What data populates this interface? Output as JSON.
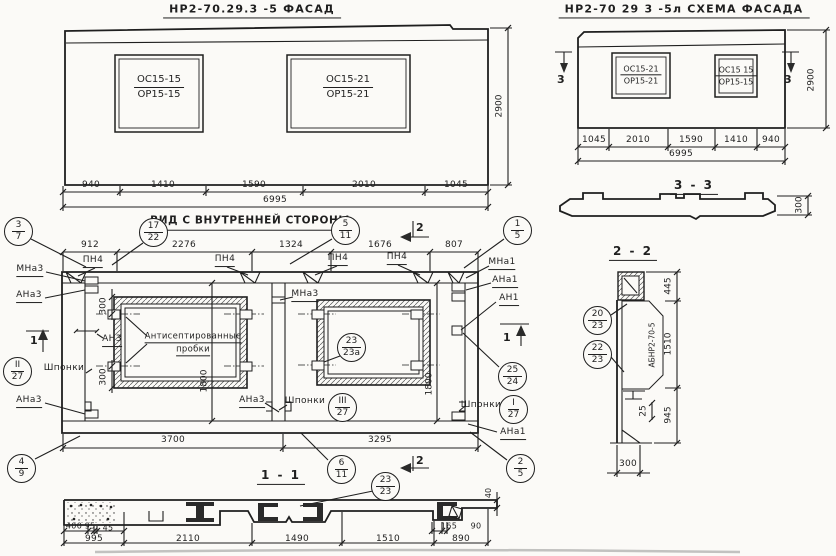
{
  "facade": {
    "title": "НР2-70.29.3 -5   ФАСАД",
    "win1": {
      "t": "ОС15-15",
      "b": "ОР15-15"
    },
    "win2": {
      "t": "ОС15-21",
      "b": "ОР15-21"
    },
    "dims": [
      "940",
      "1410",
      "1590",
      "2010",
      "1045"
    ],
    "total": "6995",
    "height": "2900"
  },
  "scheme": {
    "title": "НР2-70 29 3 -5л   СХЕМА ФАСАДА",
    "win1": {
      "t": "ОС15-21",
      "b": "ОР15-21"
    },
    "win2": {
      "t": "ОС15 15",
      "b": "ОР15-15"
    },
    "dims": [
      "1045",
      "2010",
      "1590",
      "1410",
      "940"
    ],
    "total": "6995",
    "height": "2900",
    "marker": "3"
  },
  "inner": {
    "title": "ВИД С ВНУТРЕННЕЙ СТОРОНЫ",
    "dims_top": [
      "912",
      "2276",
      "1324",
      "1676",
      "807"
    ],
    "dims_bottom": [
      "3700",
      "3295"
    ],
    "dim_1800": "1800",
    "dim_300": "300",
    "labels": {
      "pn4": "ПН4",
      "mna3": "МНа3",
      "ana3": "АНа3",
      "an3": "АН3",
      "mna1": "МНа1",
      "ana1": "АНа1",
      "an1": "АН1",
      "shponki": "Шпонки",
      "probki1": "Антисептированные",
      "probki2": "пробки"
    },
    "marker1": "1",
    "marker2": "2"
  },
  "sec11": {
    "label": "1 - 1",
    "rowA": [
      "400",
      "95",
      "45"
    ],
    "rowB": [
      "995",
      "2110",
      "1490",
      "1510",
      "890"
    ],
    "rowR": [
      "165",
      "90"
    ],
    "d40": "40"
  },
  "sec22": {
    "label": "2 - 2",
    "dims": [
      "445",
      "1510",
      "945"
    ],
    "d25": "25",
    "d300": "300",
    "part": "АБНР2-70-5"
  },
  "sec33": {
    "label": "3 - 3",
    "d300": "300"
  },
  "callouts": [
    {
      "t": "3",
      "b": "7"
    },
    {
      "t": "17",
      "b": "22"
    },
    {
      "t": "5",
      "b": "11"
    },
    {
      "t": "1",
      "b": "5"
    },
    {
      "t": "25",
      "b": "24"
    },
    {
      "t": "I",
      "b": "27"
    },
    {
      "t": "II",
      "b": "27"
    },
    {
      "t": "III",
      "b": "27"
    },
    {
      "t": "23",
      "b": "23а"
    },
    {
      "t": "2",
      "b": "5"
    },
    {
      "t": "6",
      "b": "11"
    },
    {
      "t": "4",
      "b": "9"
    },
    {
      "t": "23",
      "b": "23"
    },
    {
      "t": "20",
      "b": "23"
    },
    {
      "t": "22",
      "b": "23"
    }
  ]
}
